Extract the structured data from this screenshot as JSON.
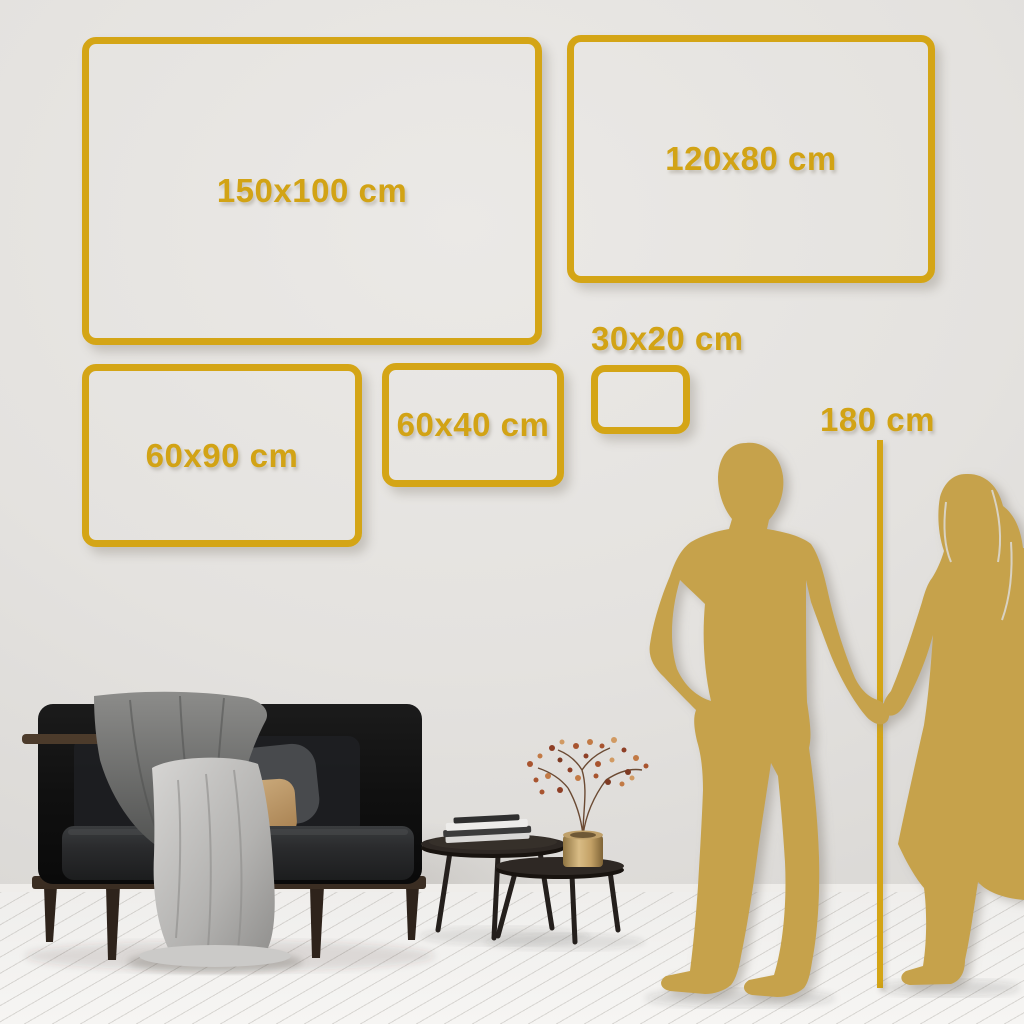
{
  "palette": {
    "accent_gold": "#D4A516",
    "silhouette_gold": "#C6A24B",
    "wall": "#E4E2DF",
    "floor": "#F4F3F1"
  },
  "size_guide": {
    "unit": "cm",
    "frames": [
      {
        "label": "150x100 cm",
        "width_cm": 150,
        "height_cm": 100
      },
      {
        "label": "120x80 cm",
        "width_cm": 120,
        "height_cm": 80
      },
      {
        "label": "60x90 cm",
        "width_cm": 90,
        "height_cm": 60
      },
      {
        "label": "60x40 cm",
        "width_cm": 60,
        "height_cm": 40
      },
      {
        "label": "30x20 cm",
        "width_cm": 30,
        "height_cm": 20
      }
    ],
    "height_marker": {
      "label": "180 cm",
      "value_cm": 180
    }
  }
}
